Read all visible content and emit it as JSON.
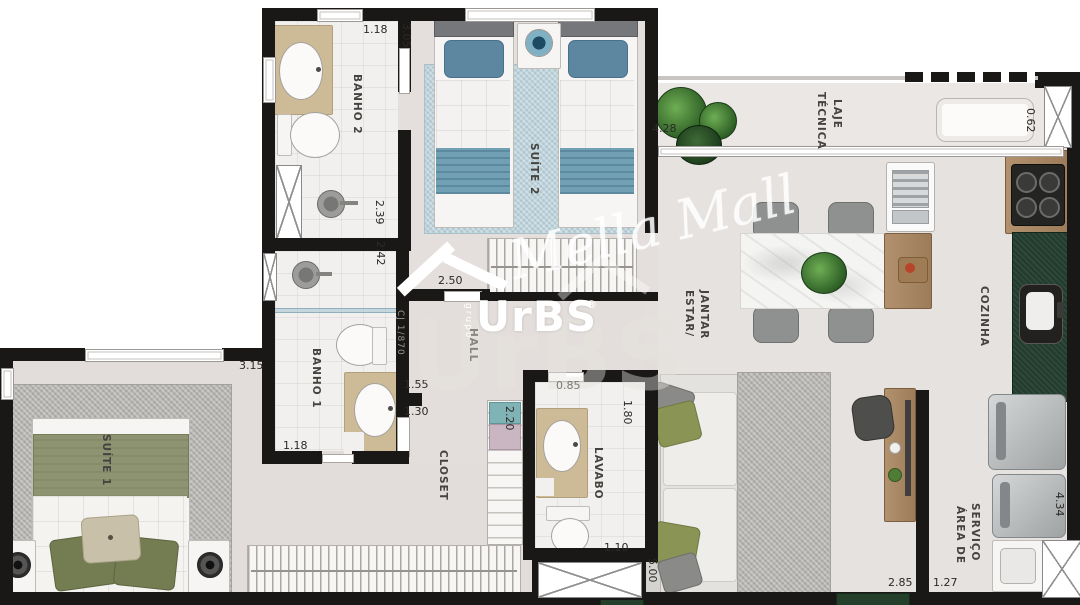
{
  "rooms": {
    "banho2": "BANHO 2",
    "suite2": "SUÍTE 2",
    "banho1": "BANHO 1",
    "hall": "HALL",
    "closet": "CLOSET",
    "lavabo": "LAVABO",
    "suite1": "SUÍTE 1",
    "estar_line1": "ESTAR/",
    "estar_line2": "JANTAR",
    "cozinha": "COZINHA",
    "laje_line1": "LAJE",
    "laje_line2": "TÉCNICA",
    "servico_line1": "ÁREA DE",
    "servico_line2": "SERVIÇO"
  },
  "measurements": {
    "banho2_door_width": "1.18",
    "suite2_depth": "3.05",
    "banho2_length": "2.39",
    "banho1_length": "2.42",
    "hall_width": "2.50",
    "hall_depth": "1.55",
    "closet_width": "1.30",
    "closet_depth": "2.20",
    "lavabo_door_width": "0.85",
    "lavabo_depth": "1.80",
    "lavabo_width": "1.10",
    "suite1_window_width": "3.15",
    "banho1_door_width": "1.18",
    "laje_width": "4.28",
    "laje_side": "0.62",
    "estar_depth": "5.00",
    "estar_width": "2.85",
    "servico_width": "1.27",
    "servico_depth": "4.34"
  },
  "watermark": {
    "grupo": "grupo",
    "brand": "UrBS",
    "registered": "®",
    "signature": "Mella Mall",
    "wall_code": "CJ 1/870"
  },
  "colors": {
    "wall": "#191817",
    "floor": "#e4dfdd",
    "suite2_accent": "#71a0b4",
    "suite1_accent": "#8e9471",
    "kitchen_counter": "#223c2e",
    "counter_beige": "#cdbb98"
  }
}
